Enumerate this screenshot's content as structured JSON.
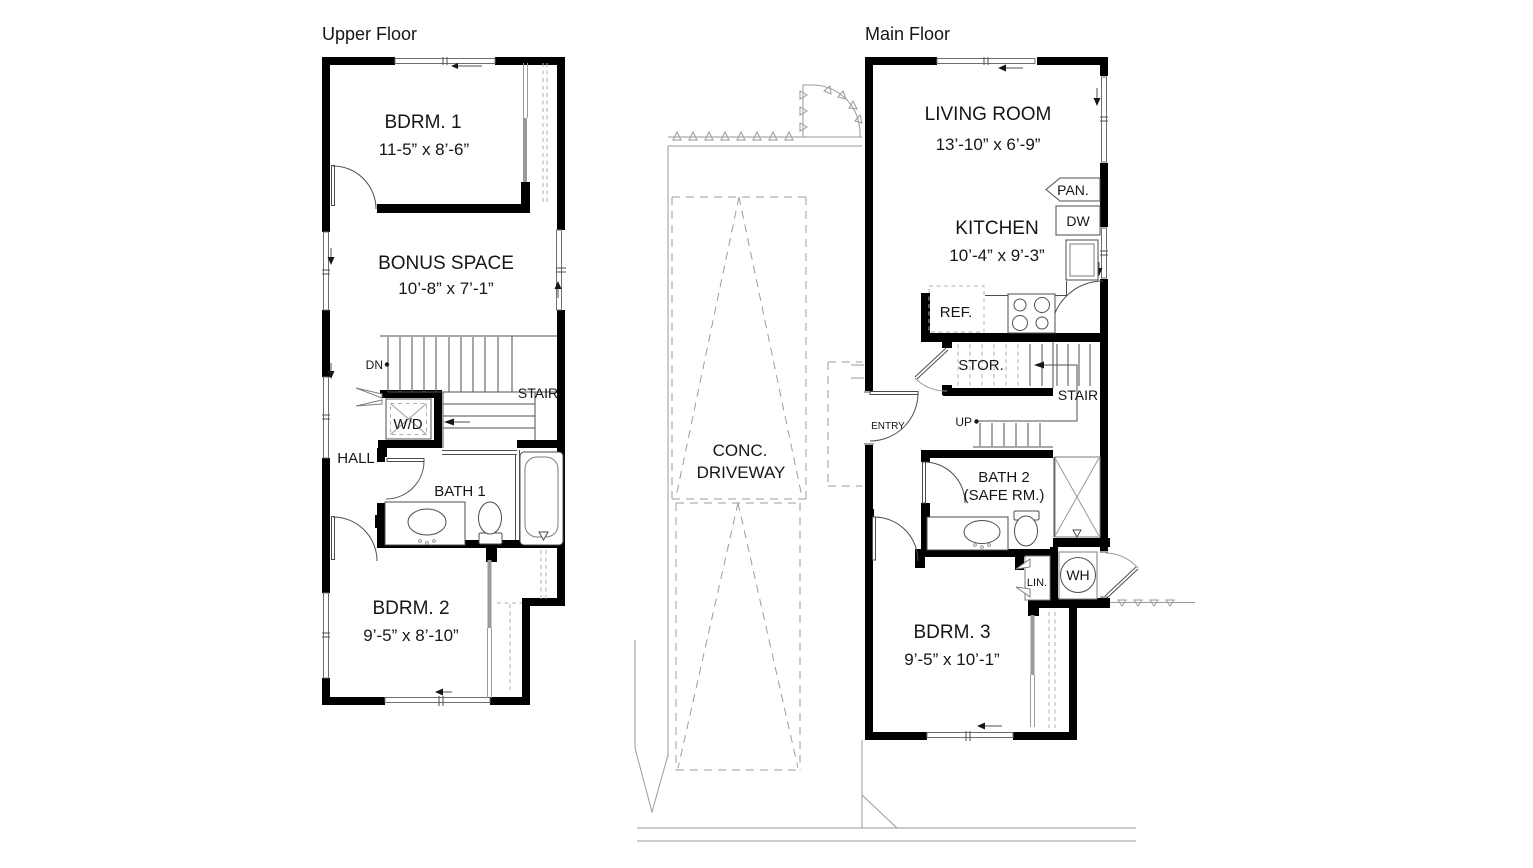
{
  "upper_floor": {
    "title": "Upper Floor",
    "rooms": {
      "bdrm1": {
        "name": "BDRM. 1",
        "dims": "11-5” x 8’-6”"
      },
      "bonus_space": {
        "name": "BONUS SPACE",
        "dims": "10’-8” x 7’-1”"
      },
      "stair": {
        "name": "STAIR",
        "direction": "DN"
      },
      "laundry": {
        "name": "W/D"
      },
      "hall": {
        "name": "HALL"
      },
      "bath1": {
        "name": "BATH 1"
      },
      "bdrm2": {
        "name": "BDRM. 2",
        "dims": "9’-5” x 8’-10”"
      }
    }
  },
  "main_floor": {
    "title": "Main Floor",
    "rooms": {
      "living": {
        "name": "LIVING ROOM",
        "dims": "13’-10” x 6’-9”"
      },
      "kitchen": {
        "name": "KITCHEN",
        "dims": "10’-4” x 9’-3”",
        "pantry": "PAN.",
        "dishwasher": "DW",
        "refrigerator": "REF."
      },
      "storage": {
        "name": "STOR."
      },
      "stair": {
        "name": "STAIR",
        "direction": "UP"
      },
      "entry": {
        "name": "ENTRY"
      },
      "bath2": {
        "name": "BATH 2",
        "sub": "(SAFE RM.)"
      },
      "linen": {
        "name": "LIN."
      },
      "water_heater": {
        "name": "WH"
      },
      "bdrm3": {
        "name": "BDRM. 3",
        "dims": "9’-5” x 10’-1”"
      }
    }
  },
  "site": {
    "driveway": {
      "line1": "CONC.",
      "line2": "DRIVEWAY"
    }
  }
}
